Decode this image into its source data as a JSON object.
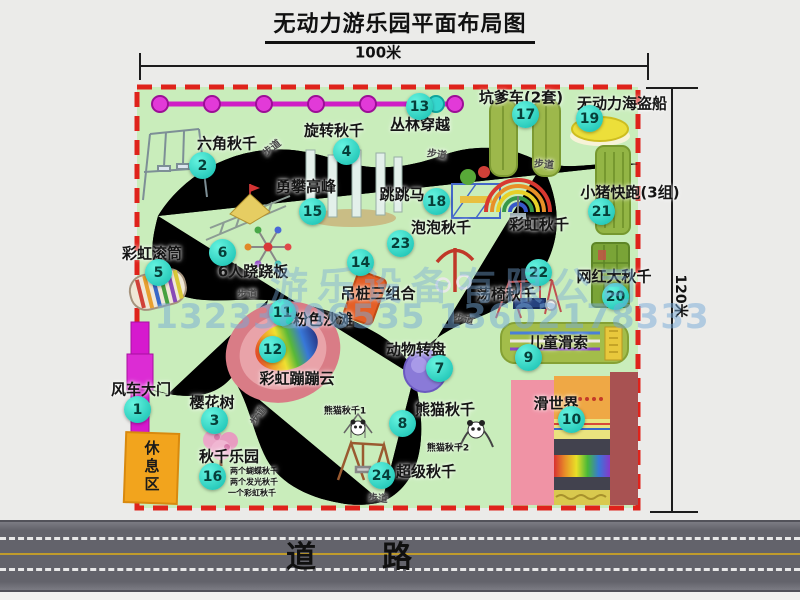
{
  "title": "无动力游乐园平面布局图",
  "dimensions": {
    "width": "100米",
    "height": "120米"
  },
  "road_label": "道　　路",
  "rest_area_label": "休息区",
  "watermark": {
    "line1": "游乐设备有限公司",
    "line2": "13233806535 13602178333"
  },
  "colors": {
    "park_green": "#c9edbb",
    "boundary_red": "#df231b",
    "badge_teal": "#12bcae",
    "path_gray": "#8f958f",
    "gate_magenta": "#d619ce",
    "zipline_magenta": "#cf1ec6",
    "rest_area_orange": "#f2a41d",
    "road_gray": "#63636b",
    "watermark_blue": "#76aad8"
  },
  "attractions": [
    {
      "num": 1,
      "name": "风车大门",
      "marker": [
        137,
        409
      ],
      "label": [
        141,
        389
      ]
    },
    {
      "num": 2,
      "name": "六角秋千",
      "marker": [
        202,
        165
      ],
      "label": [
        227,
        143
      ]
    },
    {
      "num": 3,
      "name": "樱花树",
      "marker": [
        214,
        420
      ],
      "label": [
        212,
        402
      ]
    },
    {
      "num": 4,
      "name": "旋转秋千",
      "marker": [
        346,
        151
      ],
      "label": [
        334,
        130
      ]
    },
    {
      "num": 5,
      "name": "彩虹滚筒",
      "marker": [
        158,
        272
      ],
      "label": [
        152,
        253
      ]
    },
    {
      "num": 6,
      "name": "6人跷跷板",
      "marker": [
        222,
        252
      ],
      "label": [
        253,
        271
      ]
    },
    {
      "num": 7,
      "name": "动物转盘",
      "marker": [
        439,
        368
      ],
      "label": [
        416,
        349
      ]
    },
    {
      "num": 8,
      "name": "熊猫秋千",
      "marker": [
        402,
        423
      ],
      "label": [
        445,
        409
      ]
    },
    {
      "num": 9,
      "name": "儿童滑索",
      "marker": [
        528,
        357
      ],
      "label": [
        558,
        342
      ]
    },
    {
      "num": 10,
      "name": "滑世界",
      "marker": [
        571,
        419
      ],
      "label": [
        556,
        403
      ]
    },
    {
      "num": 11,
      "name": "粉色沙滩",
      "marker": [
        282,
        312
      ],
      "label": [
        323,
        319
      ]
    },
    {
      "num": 12,
      "name": "彩虹蹦蹦云",
      "marker": [
        272,
        349
      ],
      "label": [
        297,
        378
      ]
    },
    {
      "num": 13,
      "name": "丛林穿越",
      "marker": [
        419,
        106
      ],
      "label": [
        420,
        124
      ]
    },
    {
      "num": 14,
      "name": "吊桩三组合",
      "marker": [
        360,
        262
      ],
      "label": [
        378,
        293
      ]
    },
    {
      "num": 15,
      "name": "勇攀高峰",
      "marker": [
        312,
        211
      ],
      "label": [
        306,
        186
      ]
    },
    {
      "num": 16,
      "name": "秋千乐园",
      "marker": [
        212,
        476
      ],
      "label": [
        229,
        456
      ]
    },
    {
      "num": 17,
      "name": "坑爹车(2套)",
      "marker": [
        525,
        114
      ],
      "label": [
        521,
        97
      ]
    },
    {
      "num": 18,
      "name": "跳跳马",
      "marker": [
        436,
        201
      ],
      "label": [
        402,
        194
      ]
    },
    {
      "num": 19,
      "name": "无动力海盗船",
      "marker": [
        589,
        118
      ],
      "label": [
        622,
        103
      ]
    },
    {
      "num": 20,
      "name": "网红大秋千",
      "marker": [
        615,
        296
      ],
      "label": [
        614,
        276
      ]
    },
    {
      "num": 21,
      "name": "小猪快跑(3组)",
      "marker": [
        601,
        211
      ],
      "label": [
        630,
        192
      ]
    },
    {
      "num": 22,
      "name": "荡椅秋千",
      "marker": [
        538,
        272
      ],
      "label": [
        506,
        294
      ]
    },
    {
      "num": 23,
      "name": "泡泡秋千",
      "marker": [
        400,
        243
      ],
      "label": [
        441,
        227
      ]
    },
    {
      "num": 24,
      "name": "超级秋千",
      "marker": [
        381,
        475
      ],
      "label": [
        426,
        471
      ]
    }
  ],
  "free_labels": [
    {
      "text": "彩虹秋千",
      "x": 539,
      "y": 224,
      "size": 15
    },
    {
      "text": "熊猫秋千1",
      "x": 345,
      "y": 410,
      "size": 9
    },
    {
      "text": "熊猫秋千2",
      "x": 448,
      "y": 447,
      "size": 9
    },
    {
      "text": "两个蝴蝶秋千",
      "x": 254,
      "y": 471,
      "size": 8
    },
    {
      "text": "两个发光秋千",
      "x": 254,
      "y": 482,
      "size": 8
    },
    {
      "text": "一个彩虹秋千",
      "x": 252,
      "y": 493,
      "size": 8
    }
  ],
  "path_labels": [
    {
      "text": "步道",
      "x": 271,
      "y": 147,
      "rot": -38
    },
    {
      "text": "步道",
      "x": 437,
      "y": 153,
      "rot": 8
    },
    {
      "text": "步道",
      "x": 544,
      "y": 163,
      "rot": 5
    },
    {
      "text": "步道",
      "x": 247,
      "y": 293,
      "rot": 0
    },
    {
      "text": "步道",
      "x": 464,
      "y": 318,
      "rot": 12
    },
    {
      "text": "步道",
      "x": 257,
      "y": 415,
      "rot": -55
    },
    {
      "text": "步道",
      "x": 378,
      "y": 497,
      "rot": 4
    }
  ]
}
